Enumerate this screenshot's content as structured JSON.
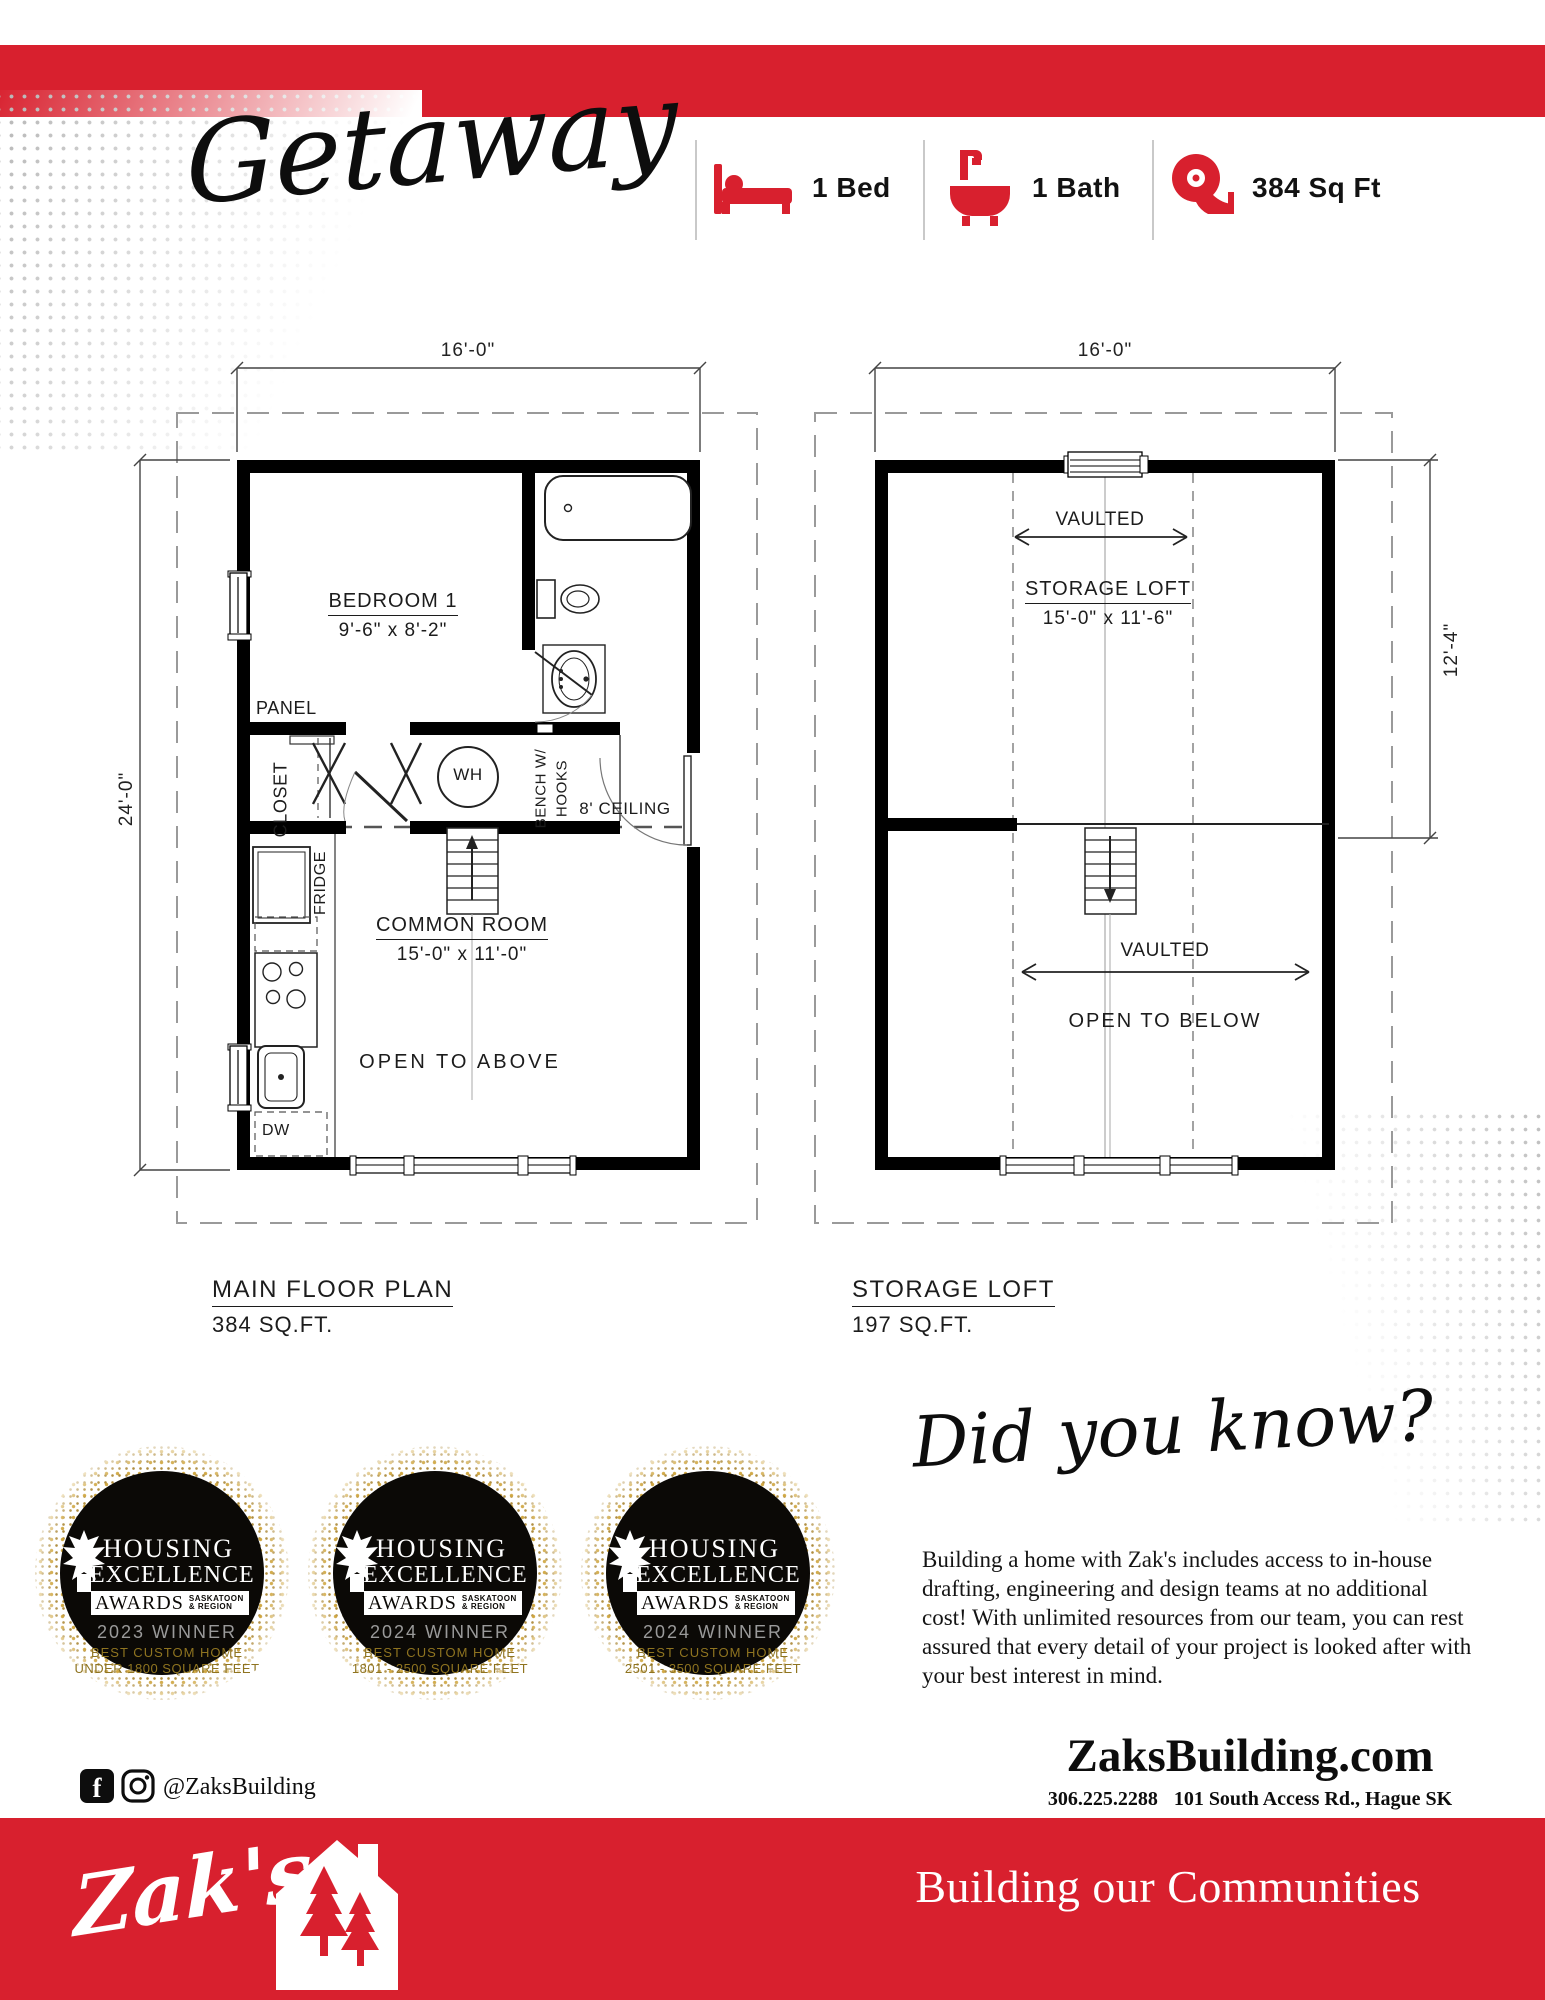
{
  "colors": {
    "brand_red": "#D8202E",
    "gold_text": "#8F7420",
    "glitter_gold": "#CEA43C",
    "winner_gray": "#9A9A9A"
  },
  "header": {
    "title": "Getaway",
    "specs": [
      {
        "icon": "bed-icon",
        "label": "1 Bed"
      },
      {
        "icon": "bath-icon",
        "label": "1 Bath"
      },
      {
        "icon": "tape-measure-icon",
        "label": "384 Sq Ft"
      }
    ]
  },
  "plans": {
    "main_floor": {
      "width_dim": "16'-0\"",
      "height_dim": "24'-0\"",
      "bedroom_name": "BEDROOM 1",
      "bedroom_dims": "9'-6\" x 8'-2\"",
      "common_name": "COMMON ROOM",
      "common_dims": "15'-0\" x 11'-0\"",
      "panel": "PANEL",
      "closet": "CLOSET",
      "wh": "WH",
      "bench": "BENCH W/",
      "hooks": "HOOKS",
      "ceiling": "8' CEILING",
      "fridge": "FRIDGE",
      "dw": "DW",
      "open_above": "OPEN TO ABOVE",
      "caption_title": "MAIN FLOOR PLAN",
      "caption_area": "384 SQ.FT."
    },
    "storage_loft": {
      "width_dim": "16'-0\"",
      "height_dim": "12'-4\"",
      "loft_name": "STORAGE LOFT",
      "loft_dims": "15'-0\" x 11'-6\"",
      "vaulted_top": "VAULTED",
      "vaulted_bottom": "VAULTED",
      "open_below": "OPEN TO BELOW",
      "caption_title": "STORAGE LOFT",
      "caption_area": "197 SQ.FT."
    }
  },
  "awards": {
    "org_line1": "HOUSING",
    "org_line2": "EXCELLENCE",
    "awards_word": "AWARDS",
    "region_line1": "SASKATOON",
    "region_line2": "& REGION",
    "badges": [
      {
        "winner": "2023 WINNER",
        "category": "BEST CUSTOM HOME",
        "size_range": "UNDER 1800 SQUARE FEET"
      },
      {
        "winner": "2024 WINNER",
        "category": "BEST CUSTOM HOME",
        "size_range": "1801 - 2500 SQUARE FEET"
      },
      {
        "winner": "2024 WINNER",
        "category": "BEST CUSTOM HOME",
        "size_range": "2501 - 3500 SQUARE FEET"
      }
    ]
  },
  "did_you_know": {
    "heading": "Did you know?",
    "body": "Building a home with Zak's includes access to in-house drafting, engineering and design teams at no additional cost! With unlimited resources from our team, you can rest assured that every detail of your project is looked after with your best interest in mind."
  },
  "footer": {
    "social_handle": "@ZaksBuilding",
    "website": "ZaksBuilding.com",
    "phone": "306.225.2288",
    "address": "101 South Access Rd., Hague SK",
    "logo_text": "Zak's",
    "tagline": "Building our Communities"
  }
}
